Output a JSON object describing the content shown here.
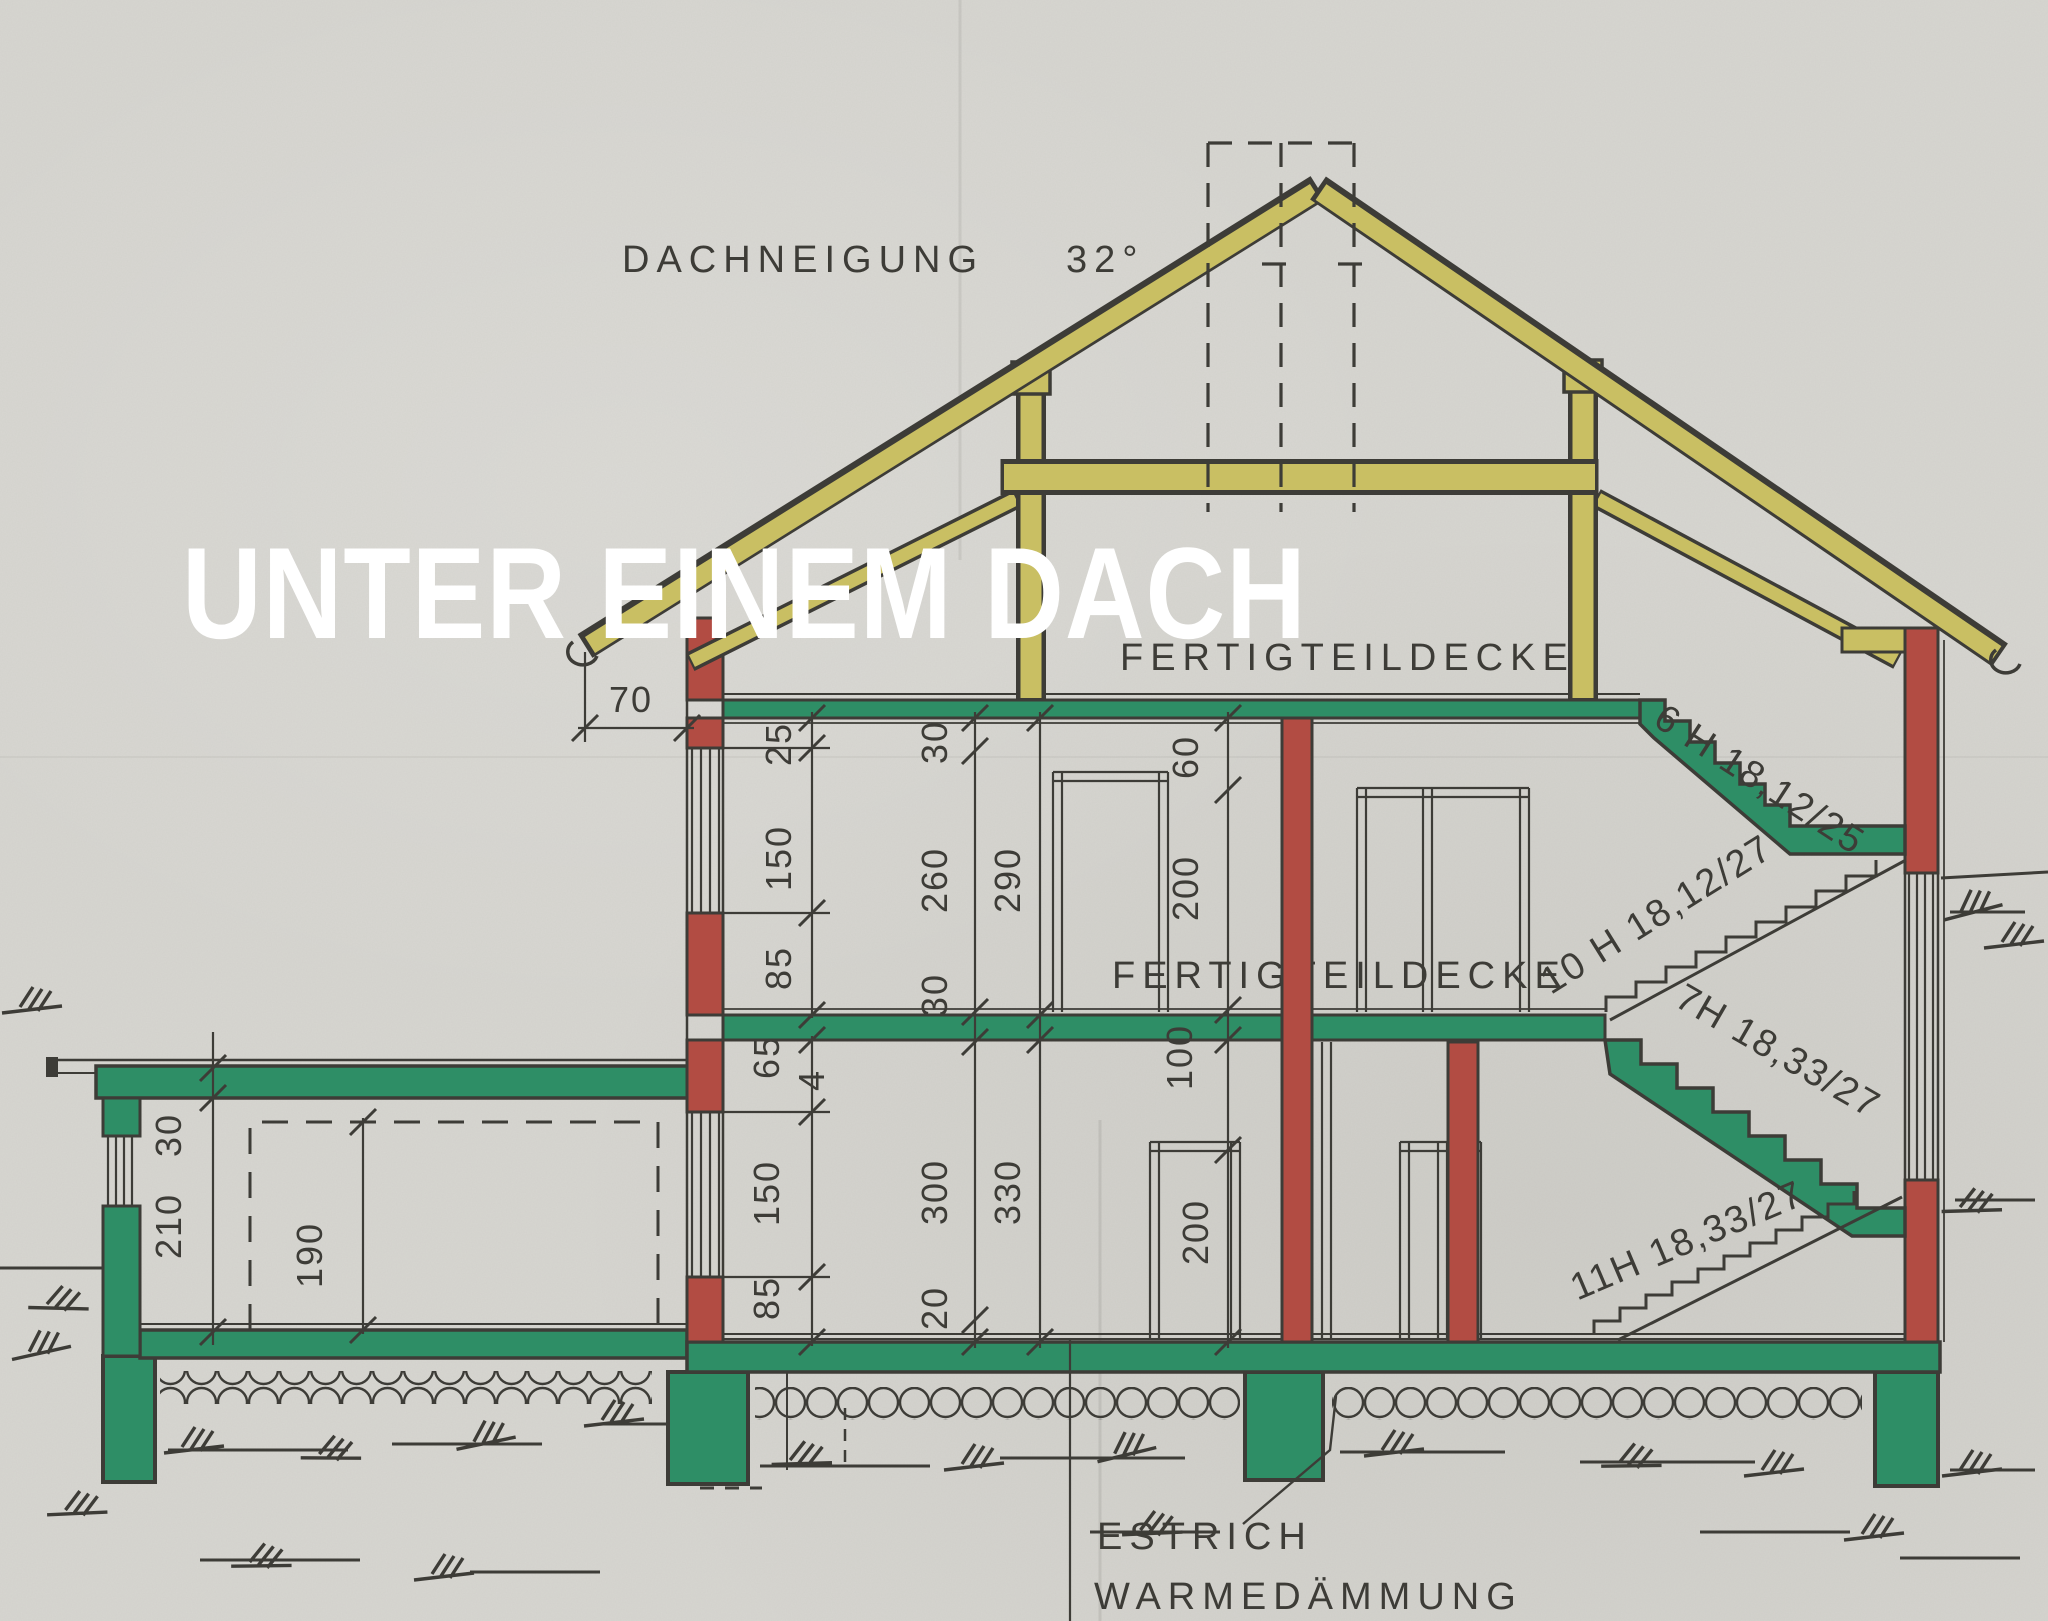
{
  "page": {
    "title": "Hausquerschnitt"
  },
  "overlay": {
    "headline": "UNTER EINEM DACH"
  },
  "drawing": {
    "roof_pitch_label": "DACHNEIGUNG",
    "roof_pitch_value": "32°",
    "attic_ceiling_label": "FERTIGTEILDECKE",
    "ground_ceiling_label": "FERTIGTEILDECKE",
    "screed_label": "ESTRICH",
    "insulation_label": "WARMEDÄMMUNG"
  },
  "stairs": {
    "attic_flight": "6 H 18,12/25",
    "upper_flight": "10 H 18,12/27",
    "mid_flight": "7H 18,33/27",
    "ground_flight": "11H 18,33/27"
  },
  "dimensions": {
    "eave_overhang": "70",
    "annex": {
      "roof_thickness": "30",
      "room_height": "210",
      "opening_height": "190"
    },
    "upper_wall": {
      "lintel": "25",
      "window": "150",
      "parapet": "85"
    },
    "lower_wall": {
      "lintel": "65",
      "window": "150",
      "parapet": "85",
      "joint": "4"
    },
    "storey_chain": {
      "s1": "30",
      "s2": "260",
      "s3": "30",
      "s4": "300",
      "s5": "20"
    },
    "clear_heights": {
      "upper": "290",
      "lower": "330"
    },
    "openings": {
      "o1": "60",
      "o2": "200",
      "o3": "100",
      "o4": "200"
    }
  },
  "colors": {
    "paper": "#d7d6d1",
    "ink": "#3d3c37",
    "slab_green": "#2e8e66",
    "brick_red": "#b24c43",
    "timber_yellow": "#c9bf63"
  }
}
